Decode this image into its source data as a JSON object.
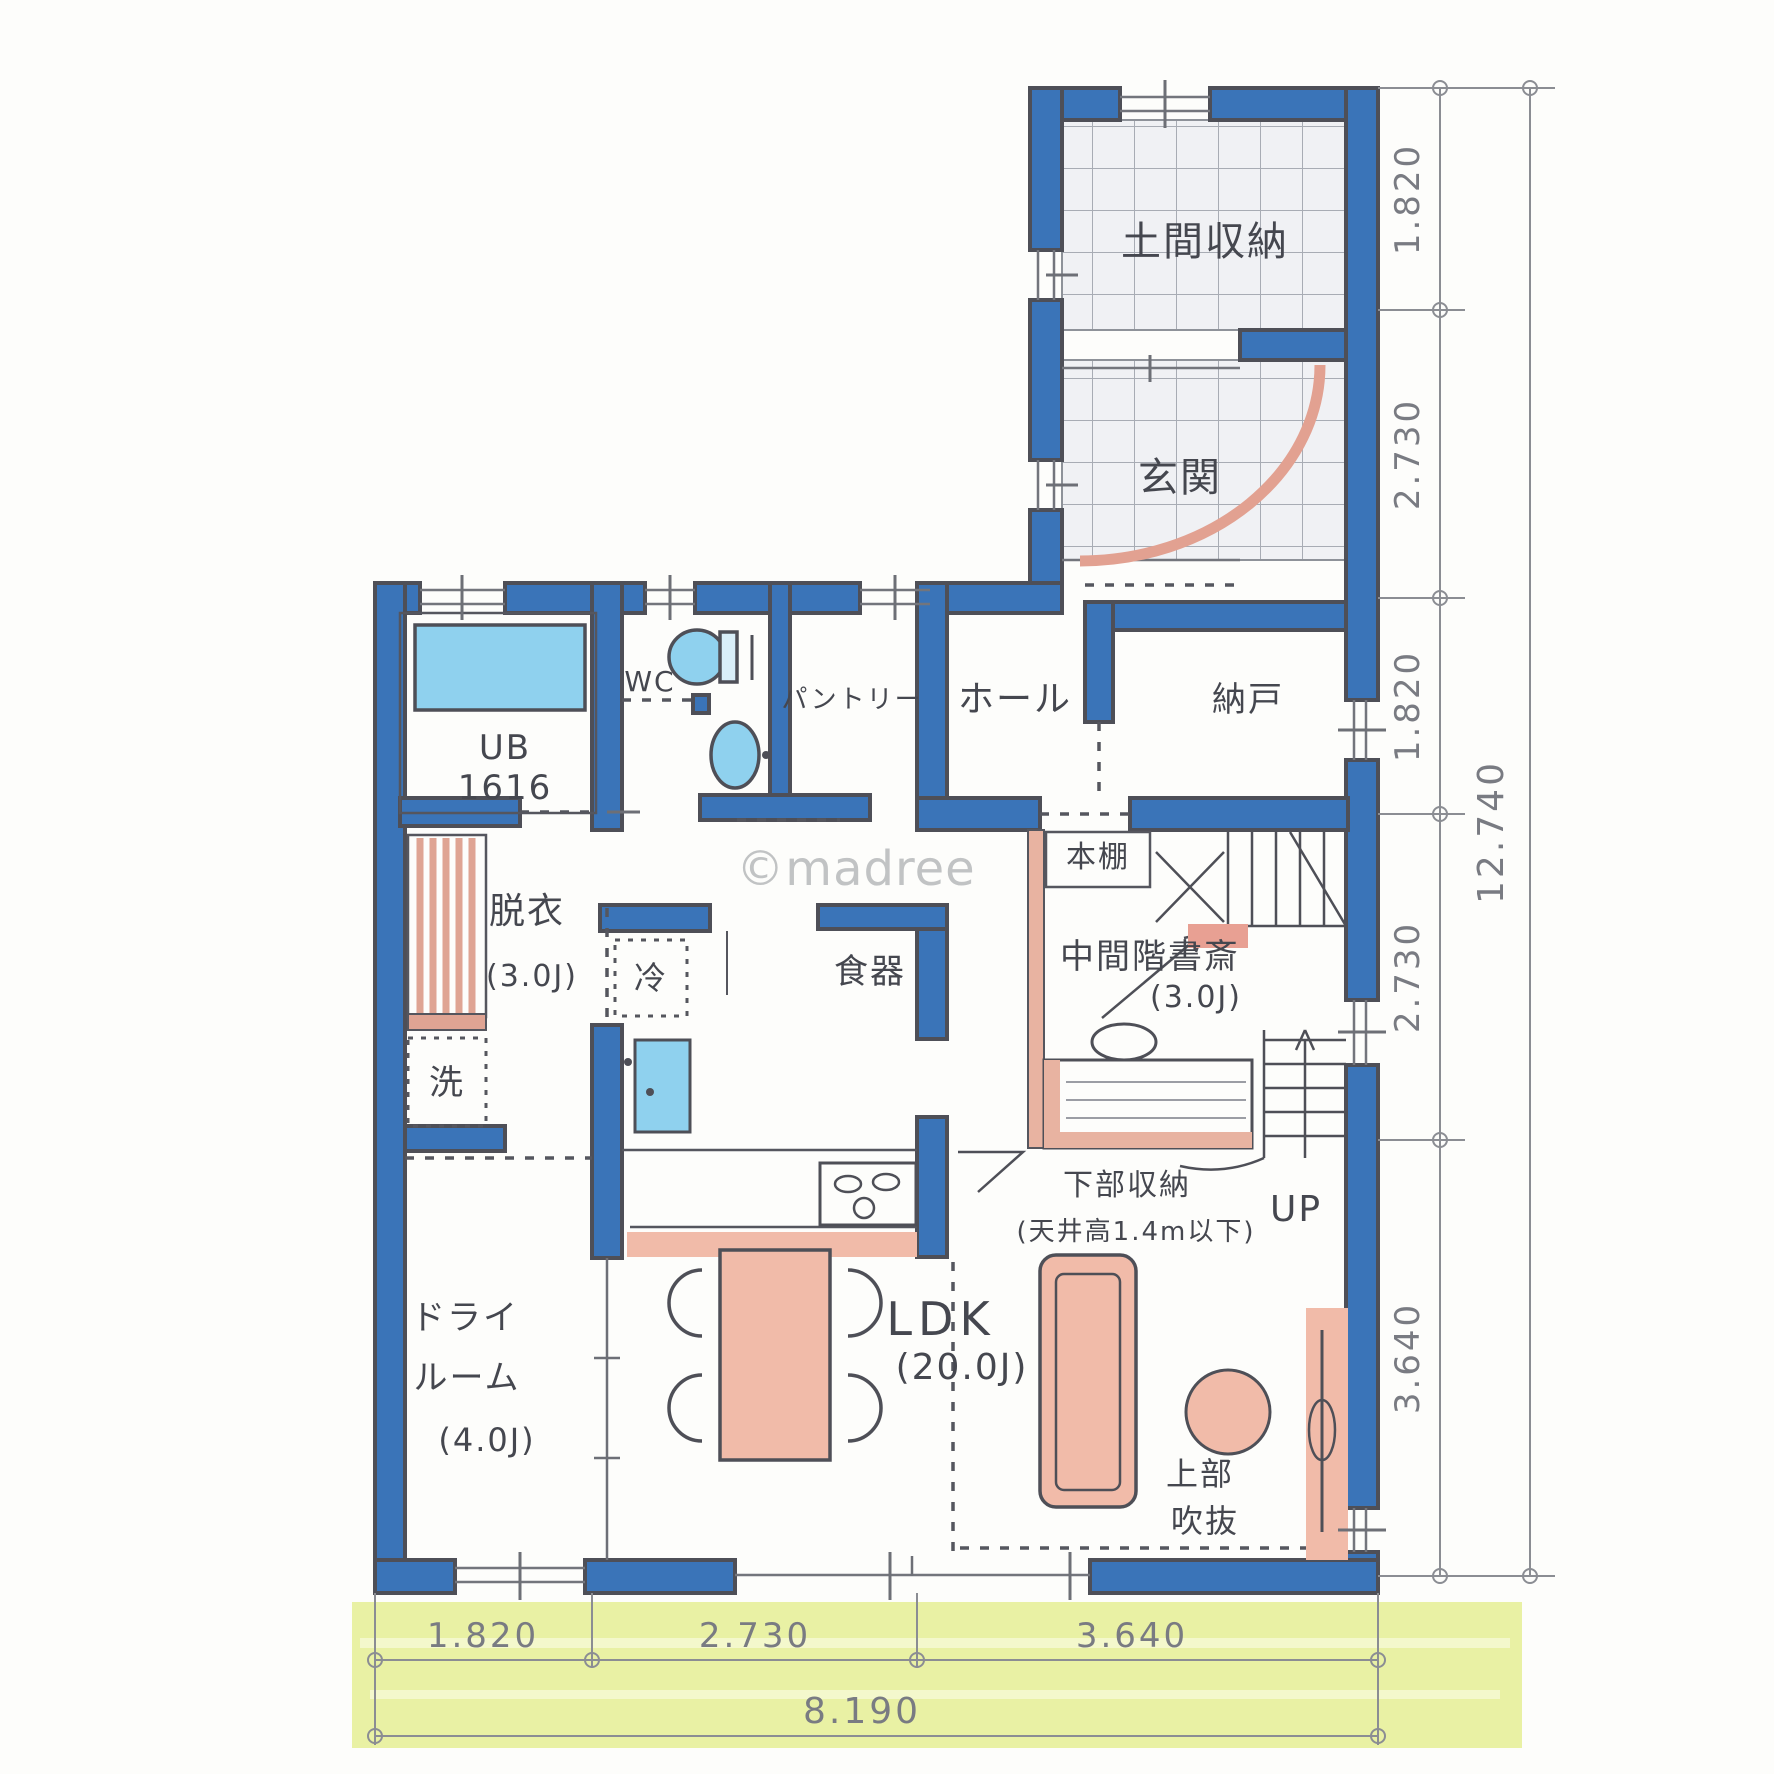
{
  "watermark": "©madree",
  "rooms": {
    "doma_storage": "土間収納",
    "genkan": "玄関",
    "ub": "UB",
    "ub_size": "1616",
    "wc": "WC",
    "pantry": "パントリー",
    "hall": "ホール",
    "nando": "納戸",
    "datsui": "脱衣",
    "datsui_size": "(3.0J)",
    "laundry": "洗",
    "fridge": "冷",
    "dishes": "食器",
    "bookshelf": "本棚",
    "study": "中間階書斎",
    "study_size": "(3.0J)",
    "lower_storage": "下部収納",
    "lower_storage_note": "(天井高1.4m以下)",
    "up": "UP",
    "dry_room_1": "ドライ",
    "dry_room_2": "ルーム",
    "dry_room_size": "(4.0J)",
    "ldk": "LDK",
    "ldk_size": "(20.0J)",
    "void_upper_1": "上部",
    "void_upper_2": "吹抜"
  },
  "dimensions": {
    "right_segments": [
      "1.820",
      "2.730",
      "1.820",
      "2.730",
      "3.640"
    ],
    "right_total": "12.740",
    "bottom_segments": [
      "1.820",
      "2.730",
      "3.640"
    ],
    "bottom_total": "8.190"
  },
  "colors": {
    "wall_blue": "#3a74b8",
    "fixture_blue": "#8fd1ee",
    "furniture_pink": "#f1bba9",
    "accent_pink": "#e2a191",
    "highlight_band": "#e9f1a4",
    "ink": "#4e4f57"
  }
}
